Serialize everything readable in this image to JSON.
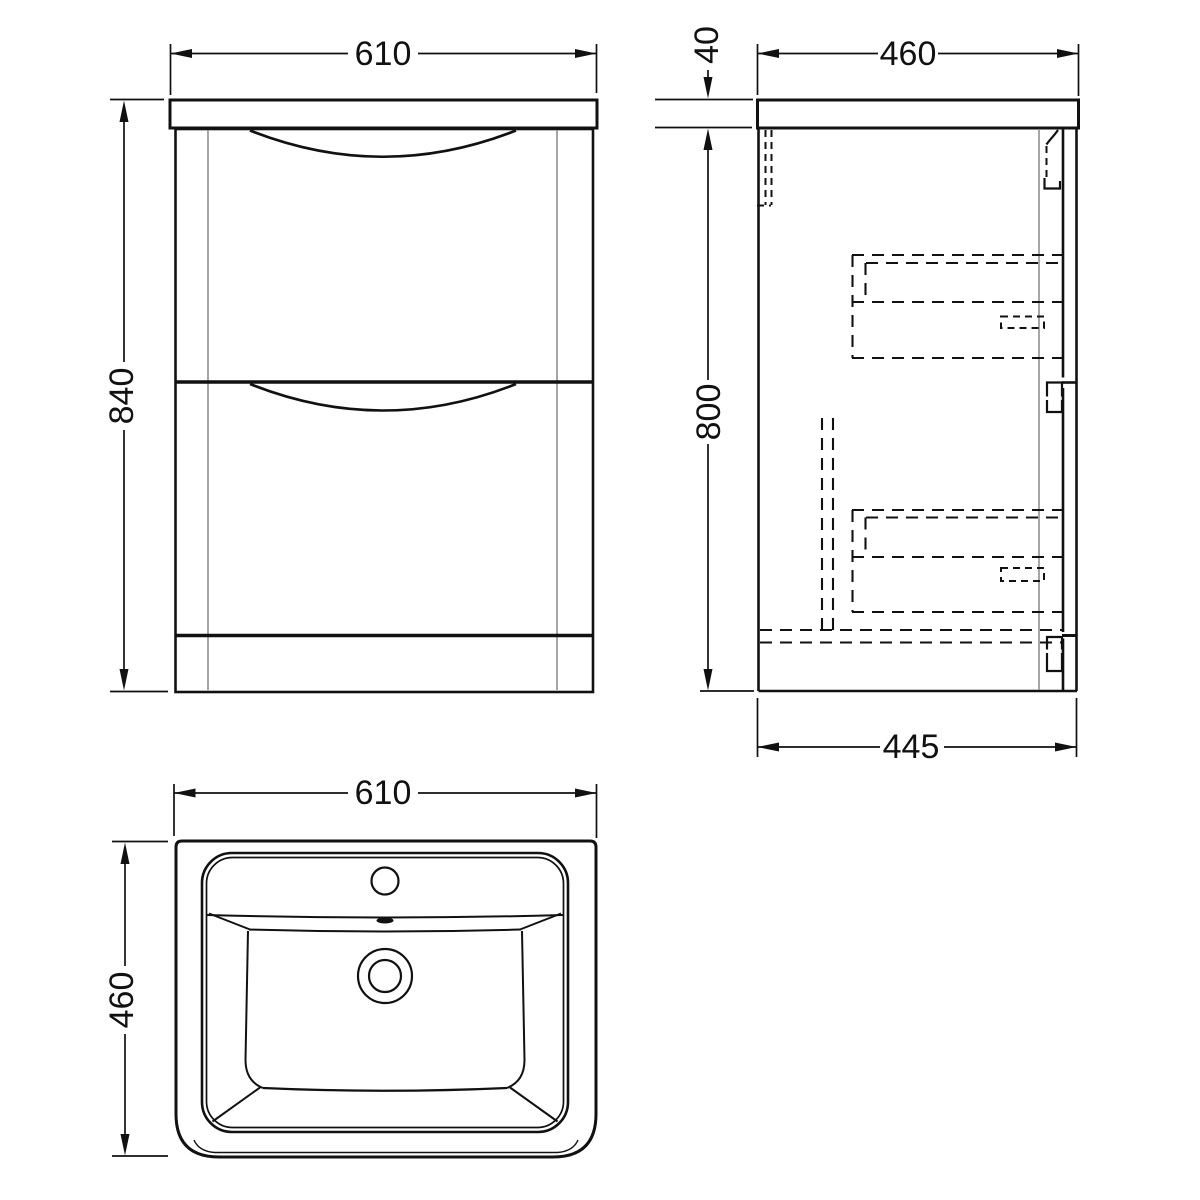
{
  "drawing": {
    "kind": "orthographic technical drawing",
    "subject": "floor-standing two-drawer vanity unit with inset basin",
    "views": [
      "front elevation",
      "side section",
      "plan of basin"
    ]
  },
  "dimensions": {
    "front_view": {
      "width": "610",
      "height": "840"
    },
    "side_view": {
      "worktop_thickness": "40",
      "top_depth": "460",
      "cabinet_height": "800",
      "cabinet_depth": "445"
    },
    "top_view": {
      "width": "610",
      "depth": "460"
    }
  },
  "colors": {
    "background": "#ffffff",
    "line": "#111111",
    "secondary_line": "#8f8f8f"
  }
}
